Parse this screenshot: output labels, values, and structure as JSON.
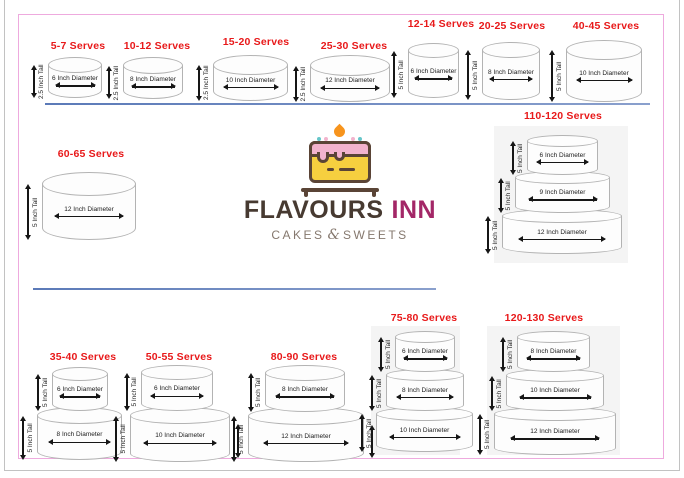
{
  "page": {
    "background": "#ffffff",
    "outer_border_color": "#c2c2c2",
    "inner_border_color": "#eeaade",
    "divider_color": "#7e97c5",
    "serves_color": "#e8191a",
    "cake_stroke": "#b3b3b3",
    "panel_color": "#f4f4f4"
  },
  "logo": {
    "title_primary": "FLAVOURS",
    "title_secondary": "INN",
    "tagline_left": "CAKES",
    "tagline_amp": "&",
    "tagline_right": "SWEETS",
    "primary_color": "#473a31",
    "secondary_color": "#a32767",
    "tagline_color": "#85786e",
    "icon_colors": {
      "body": "#f6cf3f",
      "frosting": "#f2b3cd",
      "outline": "#5a4436",
      "flame": "#f7941d",
      "sprinkle": "#66c6c9"
    }
  },
  "dividers": [
    {
      "x": 45,
      "y": 103,
      "width": 605
    },
    {
      "x": 33,
      "y": 288,
      "width": 403
    }
  ],
  "cakes": [
    {
      "serves": "5-7 Serves",
      "label": {
        "cx": 78,
        "y": 40
      },
      "tiers": [
        {
          "x": 48,
          "y": 57,
          "w": 54,
          "h": 41,
          "e": 16,
          "diameter": "6 Inch Diameter",
          "height": "2.5 Inch Tall"
        }
      ]
    },
    {
      "serves": "10-12 Serves",
      "label": {
        "cx": 157,
        "y": 40
      },
      "tiers": [
        {
          "x": 123,
          "y": 57,
          "w": 60,
          "h": 42,
          "e": 17,
          "diameter": "8 Inch Diameter",
          "height": "2.5 Inch Tall"
        }
      ]
    },
    {
      "serves": "15-20 Serves",
      "label": {
        "cx": 256,
        "y": 36
      },
      "tiers": [
        {
          "x": 213,
          "y": 55,
          "w": 75,
          "h": 46,
          "e": 20,
          "diameter": "10 Inch Diameter",
          "height": "2.5 Inch Tall"
        }
      ]
    },
    {
      "serves": "25-30 Serves",
      "label": {
        "cx": 354,
        "y": 40
      },
      "tiers": [
        {
          "x": 310,
          "y": 55,
          "w": 80,
          "h": 47,
          "e": 21,
          "diameter": "12 Inch Diameter",
          "height": "2.5 Inch Tall"
        }
      ]
    },
    {
      "serves": "12-14 Serves",
      "label": {
        "cx": 441,
        "y": 18
      },
      "tiers": [
        {
          "x": 408,
          "y": 43,
          "w": 51,
          "h": 55,
          "e": 15,
          "diameter": "6 Inch Diameter",
          "height": "5 Inch Tall"
        }
      ]
    },
    {
      "serves": "20-25 Serves",
      "label": {
        "cx": 512,
        "y": 20
      },
      "tiers": [
        {
          "x": 482,
          "y": 42,
          "w": 58,
          "h": 58,
          "e": 16,
          "diameter": "8 Inch Diameter",
          "height": "5 Inch Tall"
        }
      ]
    },
    {
      "serves": "40-45 Serves",
      "label": {
        "cx": 606,
        "y": 20
      },
      "tiers": [
        {
          "x": 566,
          "y": 40,
          "w": 76,
          "h": 62,
          "e": 20,
          "diameter": "10 Inch Diameter",
          "height": "5 Inch Tall"
        }
      ]
    },
    {
      "serves": "60-65 Serves",
      "label": {
        "cx": 91,
        "y": 148
      },
      "tiers": [
        {
          "x": 42,
          "y": 172,
          "w": 94,
          "h": 68,
          "e": 24,
          "diameter": "12 Inch Diameter",
          "height": "5 Inch Tall"
        }
      ]
    },
    {
      "serves": "110-120 Serves",
      "label": {
        "cx": 563,
        "y": 110
      },
      "panel": {
        "x": 494,
        "y": 126,
        "w": 134,
        "h": 137
      },
      "tiers": [
        {
          "x": 527,
          "y": 135,
          "w": 71,
          "h": 40,
          "e": 12,
          "diameter": "6 Inch Diameter",
          "height": "5 Inch Tall"
        },
        {
          "x": 515,
          "y": 171,
          "w": 95,
          "h": 42,
          "e": 13,
          "diameter": "9 Inch Diameter",
          "height": "5 Inch Tall"
        },
        {
          "x": 502,
          "y": 209,
          "w": 120,
          "h": 45,
          "e": 14,
          "diameter": "12 Inch Diameter",
          "height": "5 Inch Tall"
        }
      ]
    },
    {
      "serves": "35-40 Serves",
      "label": {
        "cx": 83,
        "y": 351
      },
      "tiers": [
        {
          "x": 52,
          "y": 367,
          "w": 56,
          "h": 44,
          "e": 14,
          "diameter": "6 Inch Diameter",
          "height": "5 Inch Tall"
        },
        {
          "x": 37,
          "y": 407,
          "w": 85,
          "h": 53,
          "e": 17,
          "diameter": "8 Inch Diameter",
          "height": "5 Inch Tall"
        }
      ]
    },
    {
      "serves": "50-55 Serves",
      "label": {
        "cx": 179,
        "y": 351
      },
      "tiers": [
        {
          "x": 141,
          "y": 365,
          "w": 72,
          "h": 46,
          "e": 15,
          "diameter": "6 Inch Diameter",
          "height": "5 Inch Tall"
        },
        {
          "x": 130,
          "y": 407,
          "w": 100,
          "h": 55,
          "e": 17,
          "diameter": "10 Inch Diameter",
          "height": "5 Inch Tall",
          "right_arrow": true
        }
      ]
    },
    {
      "serves": "80-90 Serves",
      "label": {
        "cx": 304,
        "y": 351
      },
      "tiers": [
        {
          "x": 265,
          "y": 365,
          "w": 80,
          "h": 47,
          "e": 16,
          "diameter": "8 Inch Diameter",
          "height": "5 Inch Tall"
        },
        {
          "x": 248,
          "y": 407,
          "w": 116,
          "h": 55,
          "e": 18,
          "diameter": "12 Inch Diameter",
          "height": "5 Inch Tall",
          "right_arrow": true
        }
      ]
    },
    {
      "serves": "75-80 Serves",
      "label": {
        "cx": 424,
        "y": 312
      },
      "panel": {
        "x": 371,
        "y": 326,
        "w": 89,
        "h": 129
      },
      "tiers": [
        {
          "x": 395,
          "y": 331,
          "w": 60,
          "h": 41,
          "e": 12,
          "diameter": "6 Inch Diameter",
          "height": "5 Inch Tall"
        },
        {
          "x": 386,
          "y": 369,
          "w": 78,
          "h": 42,
          "e": 12,
          "diameter": "8 Inch Diameter",
          "height": "5 Inch Tall"
        },
        {
          "x": 376,
          "y": 407,
          "w": 97,
          "h": 45,
          "e": 14,
          "diameter": "10 Inch Diameter",
          "height": "5 Inch Tall"
        }
      ]
    },
    {
      "serves": "120-130 Serves",
      "label": {
        "cx": 544,
        "y": 312
      },
      "panel": {
        "x": 487,
        "y": 326,
        "w": 133,
        "h": 129
      },
      "tiers": [
        {
          "x": 517,
          "y": 331,
          "w": 73,
          "h": 41,
          "e": 12,
          "diameter": "8 Inch Diameter",
          "height": "5 Inch Tall"
        },
        {
          "x": 506,
          "y": 369,
          "w": 98,
          "h": 42,
          "e": 13,
          "diameter": "10 Inch Diameter",
          "height": "5 Inch Tall"
        },
        {
          "x": 494,
          "y": 407,
          "w": 122,
          "h": 48,
          "e": 14,
          "diameter": "12 Inch Diameter",
          "height": "5 Inch Tall"
        }
      ]
    }
  ]
}
